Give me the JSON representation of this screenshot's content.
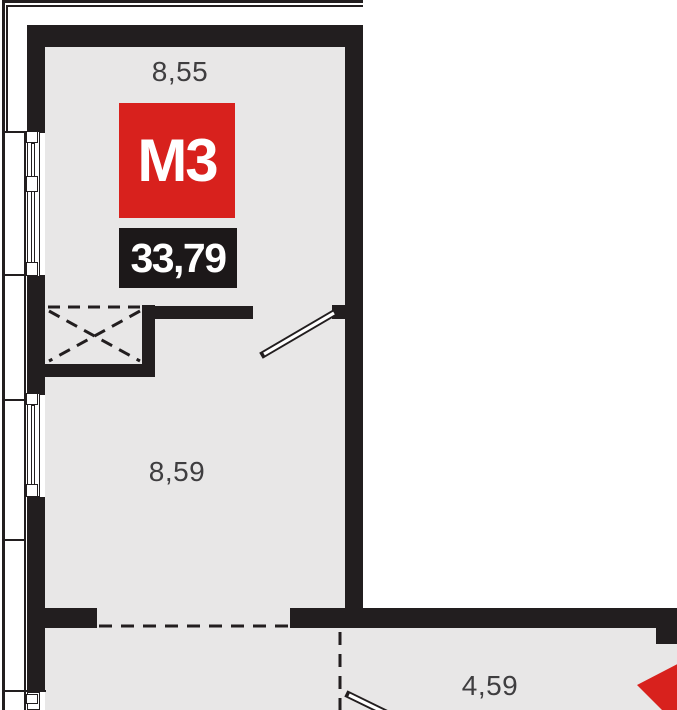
{
  "plan": {
    "unit_badge": {
      "label": "М3"
    },
    "area_badge": {
      "value": "33,79"
    },
    "dimensions": {
      "top": "8,55",
      "middle": "8,59",
      "bottom_right": "4,59"
    },
    "colors": {
      "wall": "#221e1f",
      "floor": "#e8e7e7",
      "red": "#d8211d",
      "badge": "#1c1819",
      "dim": "#3f3e40"
    }
  }
}
